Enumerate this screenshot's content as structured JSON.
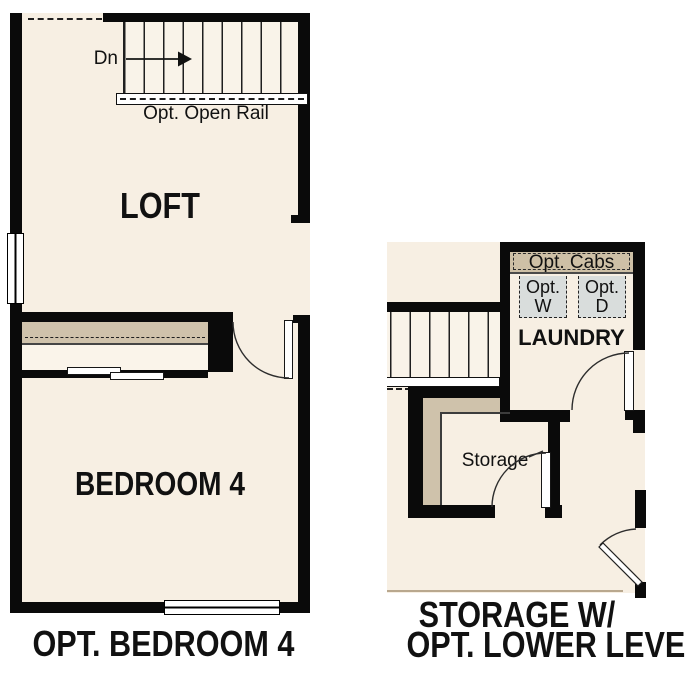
{
  "colors": {
    "wall": "#0a0a0a",
    "floor": "#f7efe3",
    "stair": "#f9f3e9",
    "closet_strip": "#faf4ea",
    "tan": "#cfc2ab",
    "cab_tan": "#cec0a6",
    "appliance": "#d9dddc",
    "line": "#1f1f1f",
    "floor_edge": "#b9a88e",
    "white": "#ffffff"
  },
  "left_plan": {
    "caption": "OPT. BEDROOM 4",
    "loft_label": "LOFT",
    "bedroom_label": "BEDROOM 4",
    "stair_direction": "Dn",
    "rail_label": "Opt. Open Rail"
  },
  "right_plan": {
    "caption_line1": "STORAGE W/",
    "caption_line2": "OPT. LOWER LEVEL",
    "laundry_label": "LAUNDRY",
    "storage_label": "Storage",
    "opt_cabs_label": "Opt. Cabs",
    "washer": {
      "line1": "Opt.",
      "line2": "W"
    },
    "dryer": {
      "line1": "Opt.",
      "line2": "D"
    }
  }
}
